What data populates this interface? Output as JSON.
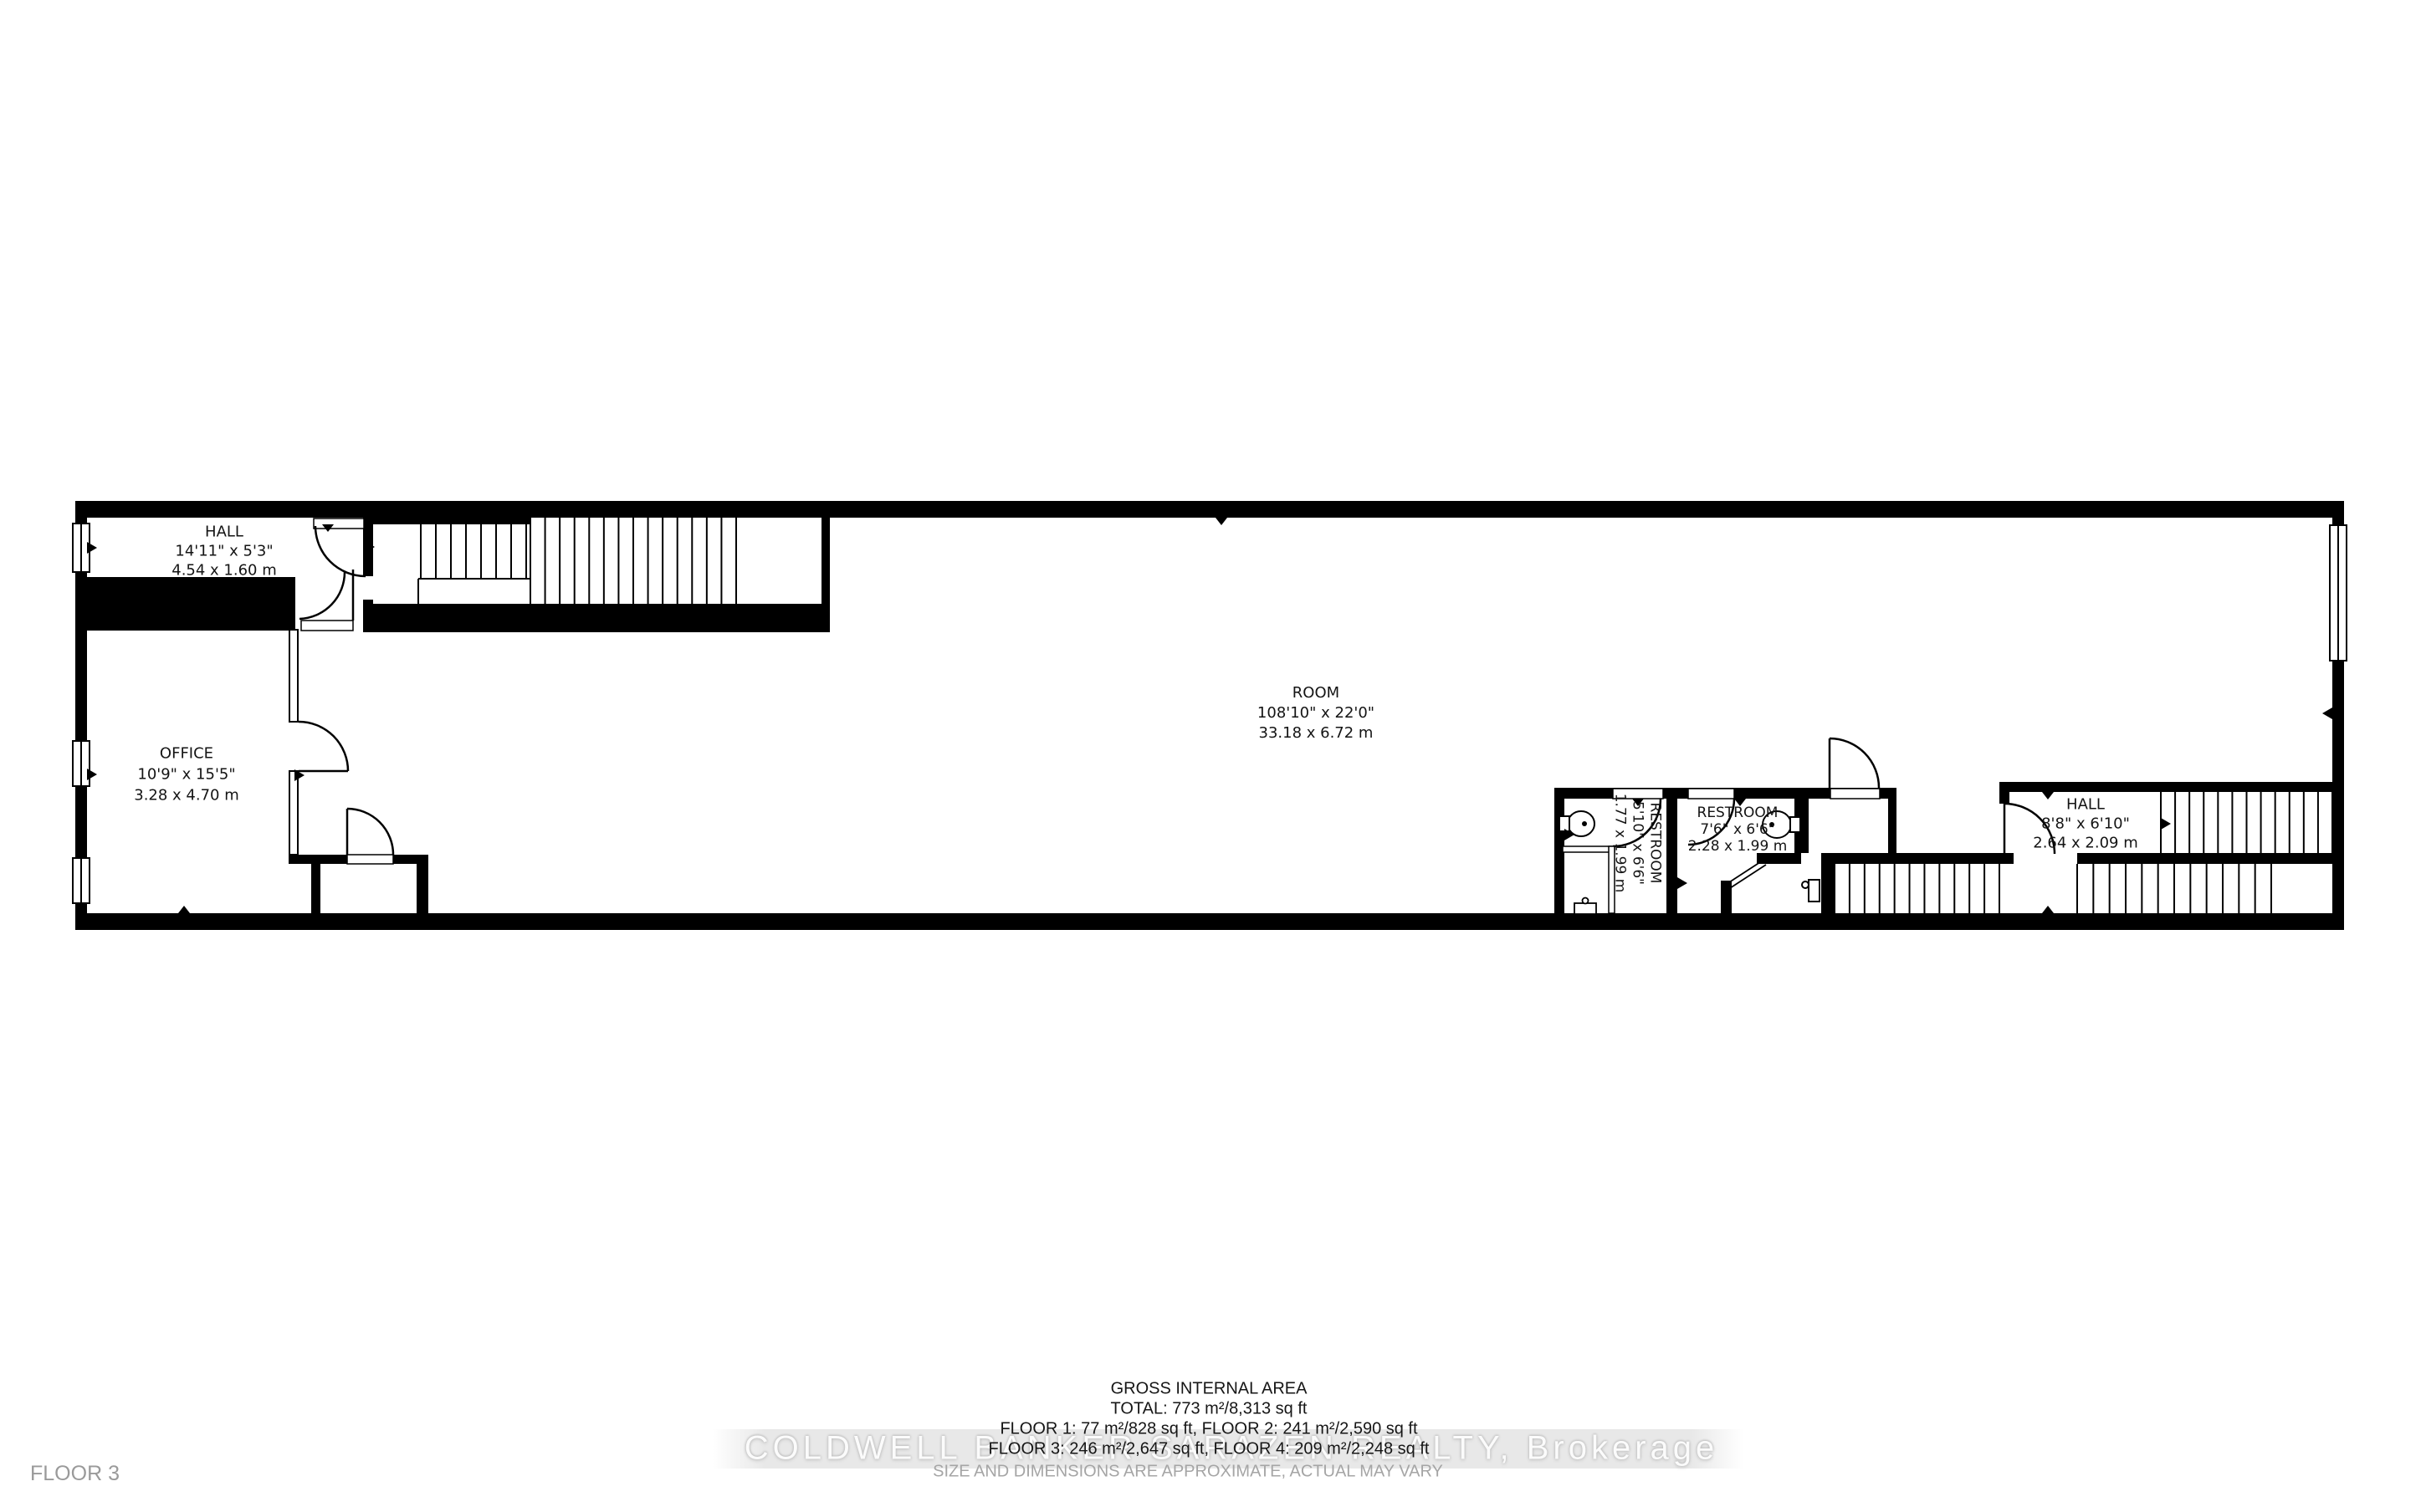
{
  "floor_label": "FLOOR 3",
  "rooms": {
    "hall_left": {
      "name": "HALL",
      "dims_ft": "14'11\" x 5'3\"",
      "dims_m": "4.54 x 1.60 m"
    },
    "office": {
      "name": "OFFICE",
      "dims_ft": "10'9\" x 15'5\"",
      "dims_m": "3.28 x 4.70 m"
    },
    "room": {
      "name": "ROOM",
      "dims_ft": "108'10\" x 22'0\"",
      "dims_m": "33.18 x 6.72 m"
    },
    "restroom_left": {
      "name": "RESTROOM",
      "dims_ft": "5'10\" x 6'6\"",
      "dims_m": "1.77 x 1.99 m"
    },
    "restroom_right": {
      "name": "RESTROOM",
      "dims_ft": "7'6\" x 6'6\"",
      "dims_m": "2.28 x 1.99 m"
    },
    "hall_right": {
      "name": "HALL",
      "dims_ft": "8'8\" x 6'10\"",
      "dims_m": "2.64 x 2.09 m"
    }
  },
  "summary": {
    "title": "GROSS INTERNAL AREA",
    "total": "TOTAL: 773 m²/8,313 sq ft",
    "floors_1_2": "FLOOR 1: 77 m²/828 sq ft, FLOOR 2: 241 m²/2,590 sq ft",
    "floors_3_4": "FLOOR 3: 246 m²/2,647 sq ft, FLOOR 4: 209 m²/2,248 sq ft",
    "disclaimer": "SIZE AND DIMENSIONS ARE APPROXIMATE, ACTUAL MAY VARY"
  },
  "watermark": "COLDWELL BANKER SARAZEN REALTY, Brokerage",
  "colors": {
    "wall": "#000000",
    "background": "#ffffff",
    "label_text": "#141414",
    "muted_text": "#9a9a9a",
    "watermark_text": "#fbfbfb",
    "watermark_band": "#e7e7e7"
  }
}
